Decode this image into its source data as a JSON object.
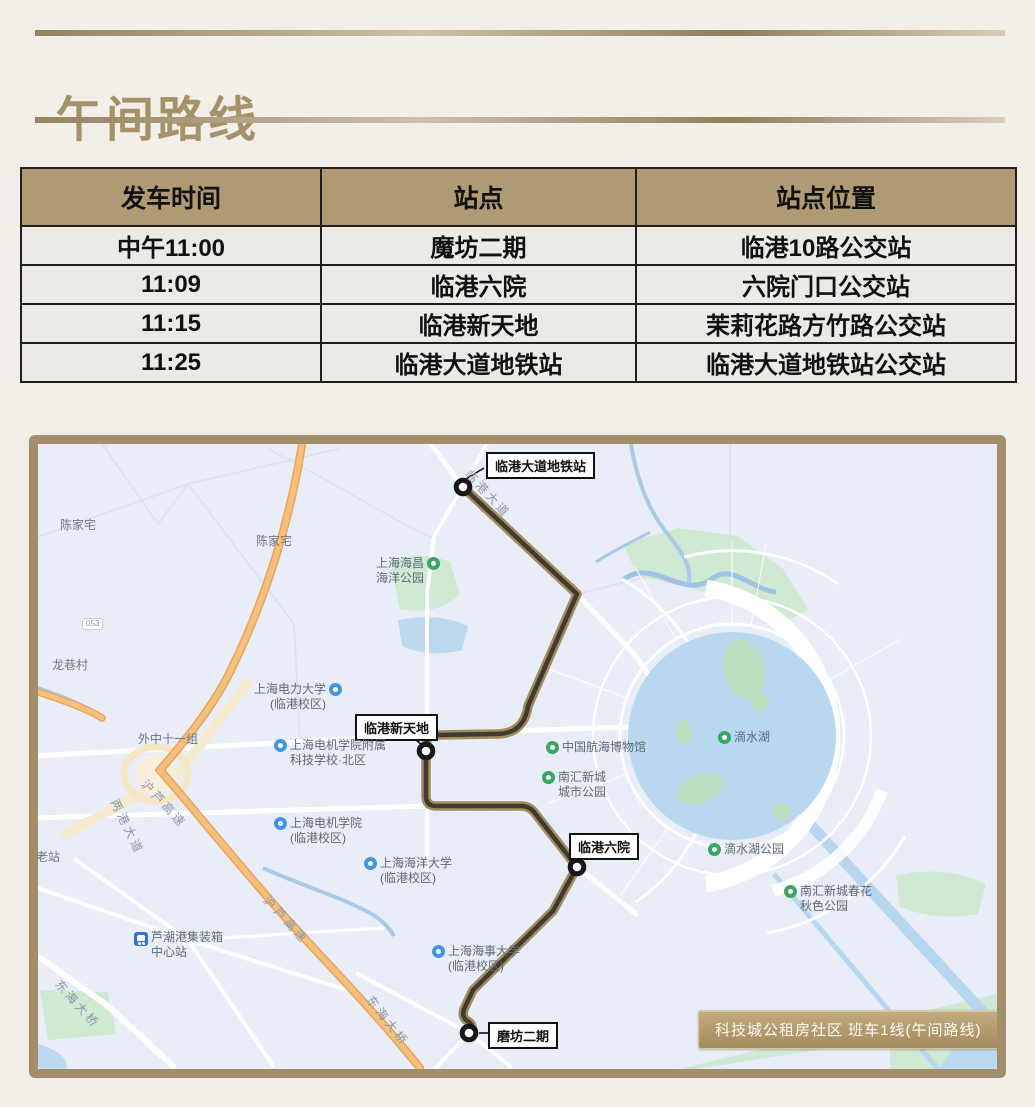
{
  "title": "午间路线",
  "table": {
    "headers": [
      "发车时间",
      "站点",
      "站点位置"
    ],
    "rows": [
      [
        "中午11:00",
        "魔坊二期",
        "临港10路公交站"
      ],
      [
        "11:09",
        "临港六院",
        "六院门口公交站"
      ],
      [
        "11:15",
        "临港新天地",
        "茉莉花路方竹路公交站"
      ],
      [
        "11:25",
        "临港大道地铁站",
        "临港大道地铁站公交站"
      ]
    ]
  },
  "map": {
    "badge": "科技城公租房社区 班车1线(午间路线)",
    "stations": [
      {
        "label": "临港大道地铁站"
      },
      {
        "label": "临港新天地"
      },
      {
        "label": "临港六院"
      },
      {
        "label": "磨坊二期"
      }
    ],
    "pois": [
      {
        "line1": "陈家宅"
      },
      {
        "line1": "陈家宅"
      },
      {
        "line1": "上海海昌",
        "line2": "海洋公园"
      },
      {
        "line1": "外中十一组"
      },
      {
        "line1": "上海电力大学",
        "line2": "(临港校区)"
      },
      {
        "line1": "上海电机学院附属",
        "line2": "科技学校·北区"
      },
      {
        "line1": "中国航海博物馆"
      },
      {
        "line1": "南汇新城",
        "line2": "城市公园"
      },
      {
        "line1": "上海电机学院",
        "line2": "(临港校区)"
      },
      {
        "line1": "上海海洋大学",
        "line2": "(临港校区)"
      },
      {
        "line1": "滴水湖"
      },
      {
        "line1": "滴水湖公园"
      },
      {
        "line1": "南汇新城春花",
        "line2": "秋色公园"
      },
      {
        "line1": "上海海事大学",
        "line2": "(临港校区)"
      },
      {
        "line1": "芦潮港集装箱",
        "line2": "中心站"
      },
      {
        "line1": "龙巷村"
      },
      {
        "line1": "老站"
      },
      {
        "line1": "053"
      }
    ],
    "roads": [
      {
        "label": "临港大道"
      },
      {
        "label": "沪芦高速"
      },
      {
        "label": "沪芦高速"
      },
      {
        "label": "两港大道"
      },
      {
        "label": "东海大桥"
      },
      {
        "label": "东海大桥"
      }
    ]
  },
  "colors": {
    "accent": "#a7936c",
    "table_header_bg": "#b09a74",
    "route": "#3f3a32",
    "route_casing": "#a28c5c",
    "highway": "#f5bf7d",
    "lake": "#b9d8ef",
    "park": "#cfe9d2",
    "map_border": "#a28e6a"
  }
}
